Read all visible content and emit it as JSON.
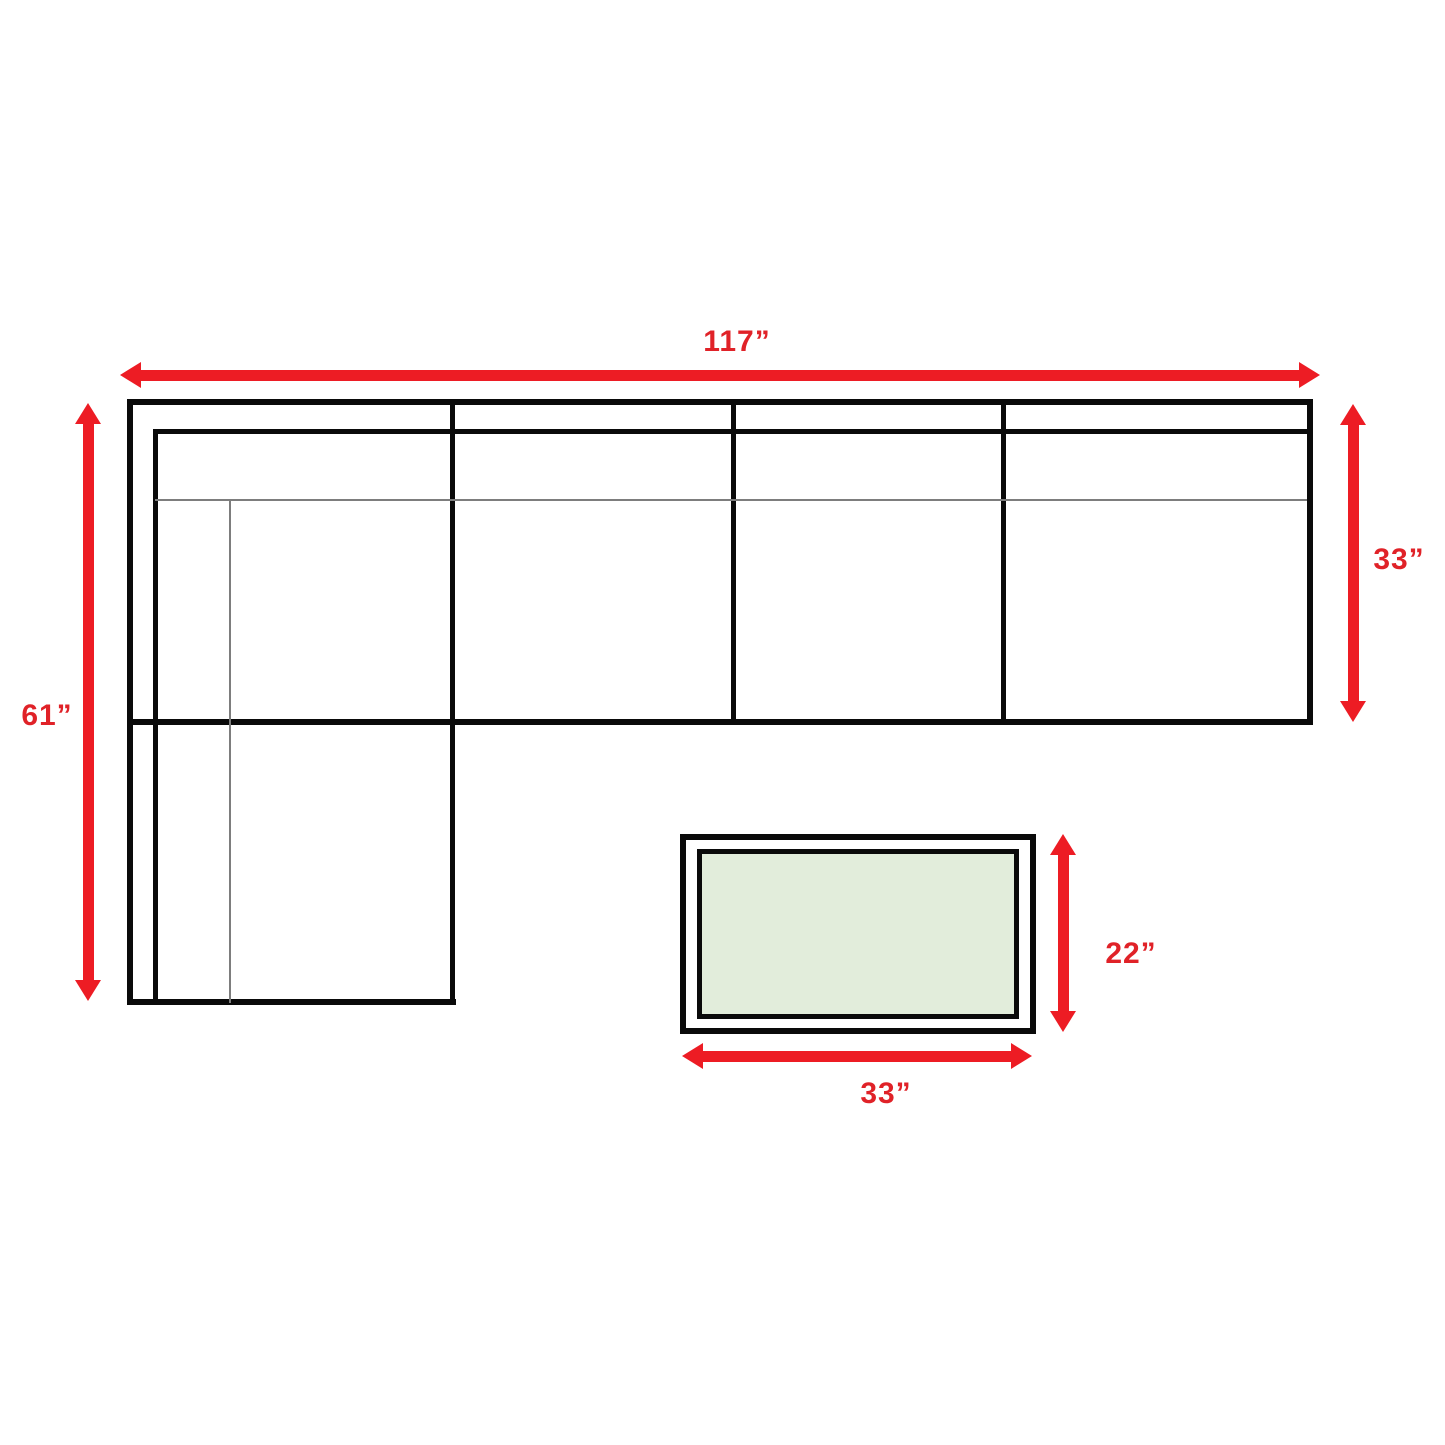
{
  "labels": {
    "sofa_width": "117”",
    "sofa_depth_left": "61”",
    "sofa_depth_right": "33”",
    "table_depth": "22”",
    "table_width": "33”"
  },
  "colors": {
    "arrow_red": "#ed1c24",
    "label_red": "#e02228",
    "outline_black": "#0a0a0a",
    "seam_gray": "#7d7d7d",
    "table_fill": "#e2eddb",
    "background": "#ffffff"
  }
}
